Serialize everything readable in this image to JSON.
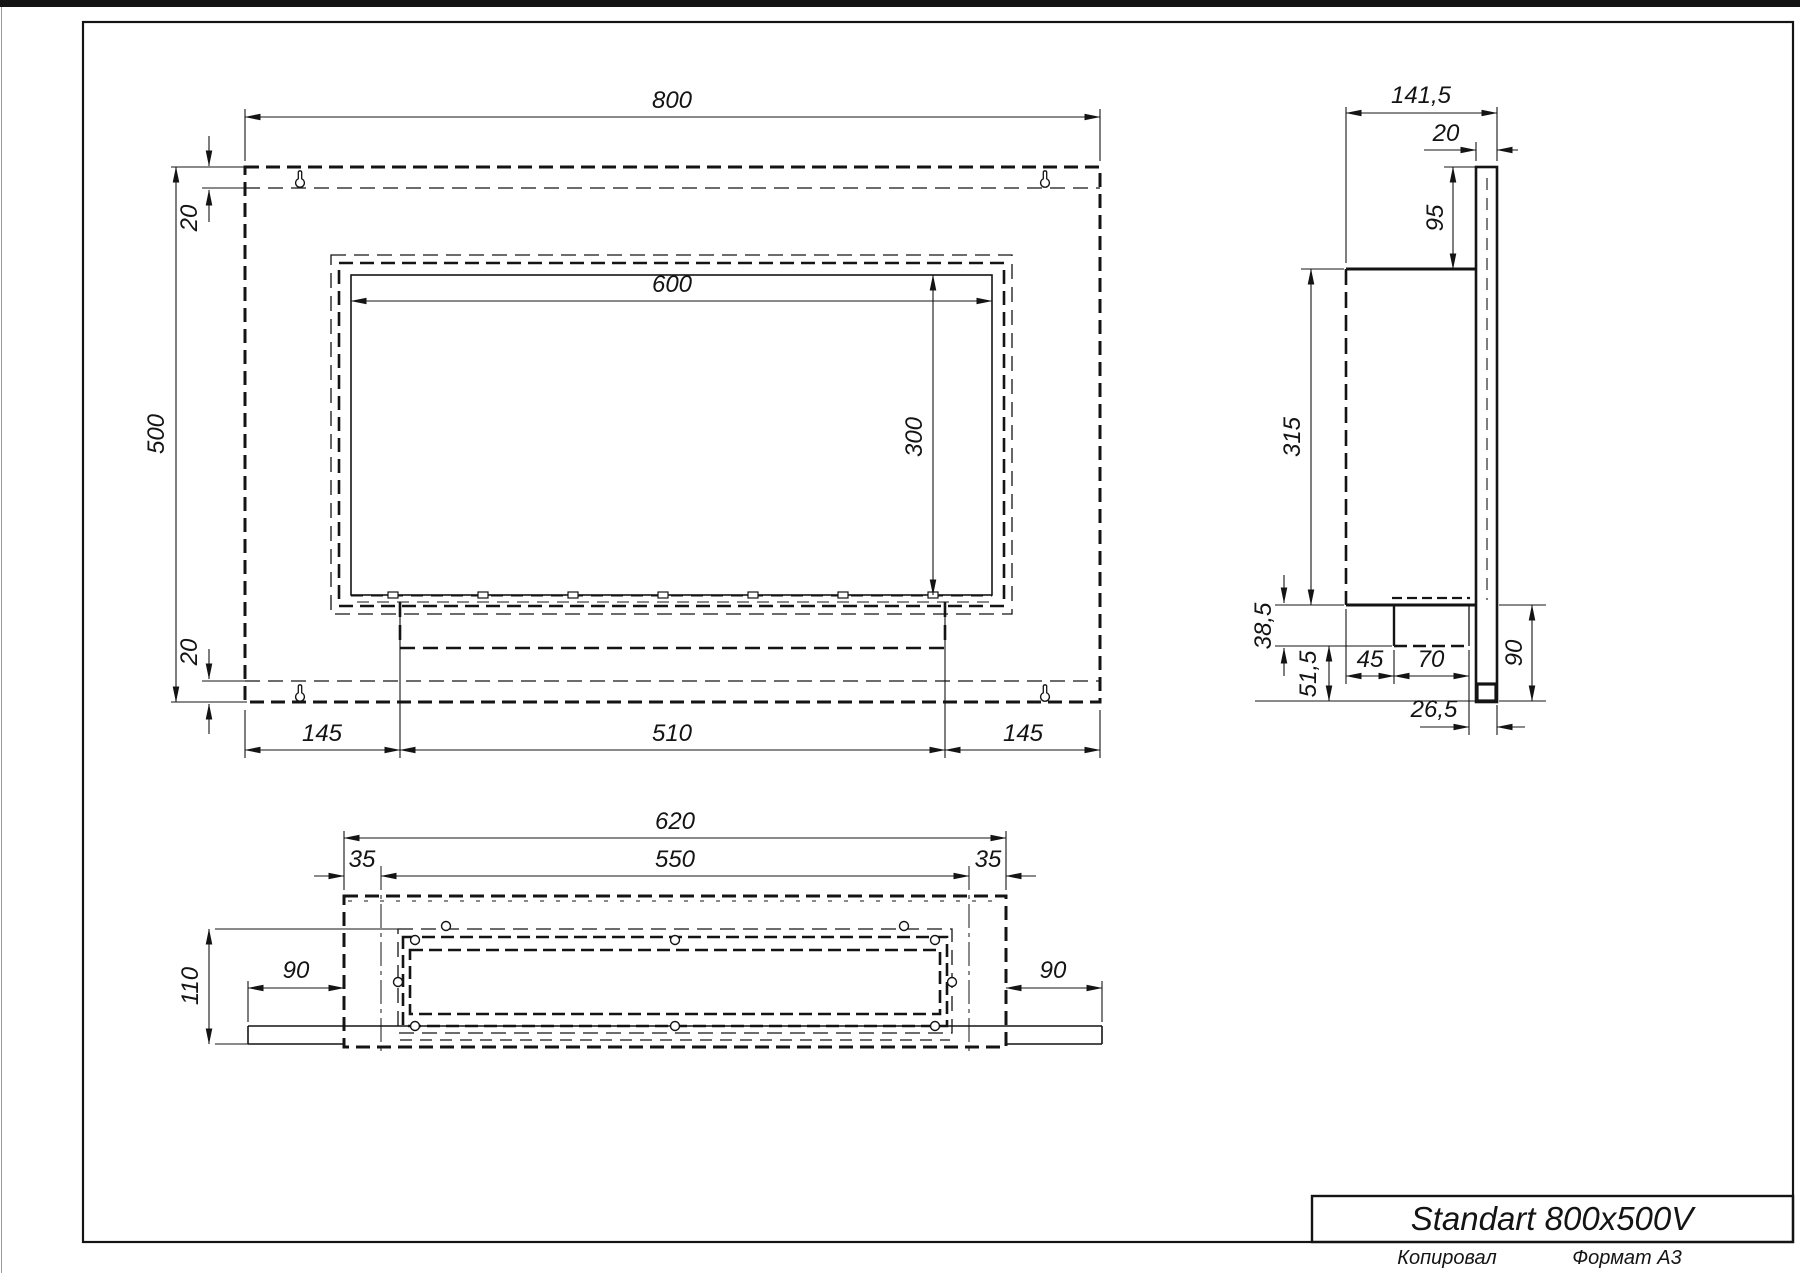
{
  "front": {
    "width": "800",
    "height": "500",
    "top_offset": "20",
    "bottom_offset": "20",
    "opening_width": "600",
    "opening_height": "300",
    "margin_left": "145",
    "slot_width": "510",
    "margin_right": "145"
  },
  "side": {
    "depth": "141,5",
    "plate_thickness": "20",
    "top_to_opening": "95",
    "body_height": "315",
    "under_body": "38,5",
    "lower_gap": "51,5",
    "front_offset": "45",
    "burner_width": "70",
    "plate_drop": "90",
    "back_offset": "26,5"
  },
  "bottom": {
    "outer_width": "620",
    "inner_width": "550",
    "inset_left": "35",
    "inset_right": "35",
    "depth": "110",
    "flange_left": "90",
    "flange_right": "90"
  },
  "title_block": {
    "model": "Standart 800x500V"
  },
  "footer": {
    "copied_by": "Копировал",
    "format": "Формат А3"
  },
  "colors": {
    "ink": "#141414",
    "paper": "#ffffff"
  }
}
